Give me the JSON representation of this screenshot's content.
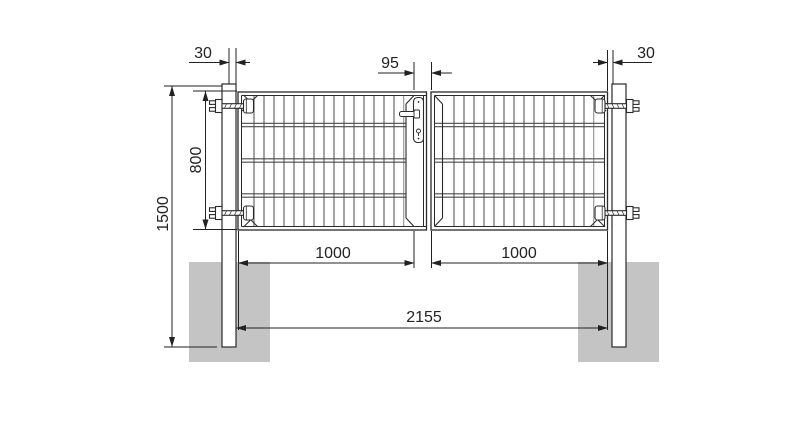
{
  "drawing": {
    "kind": "double-wing gate front elevation"
  },
  "dimensions": {
    "left_post_offset": "30",
    "center_clearance": "95",
    "right_post_offset": "30",
    "leaf_height": "800",
    "post_height": "1500",
    "left_leaf_width": "1000",
    "right_leaf_width": "1000",
    "overall_width": "2155"
  },
  "icons": {
    "hinge": "hinge-icon",
    "lock": "lock-icon",
    "handle": "handle-icon"
  },
  "colors": {
    "line": "#2a2a2a",
    "mesh": "#5a5a5a",
    "wire_band": "#4a4a4a",
    "dimension": "#222222",
    "foundation": "#c4c4c4",
    "background": "#ffffff"
  }
}
